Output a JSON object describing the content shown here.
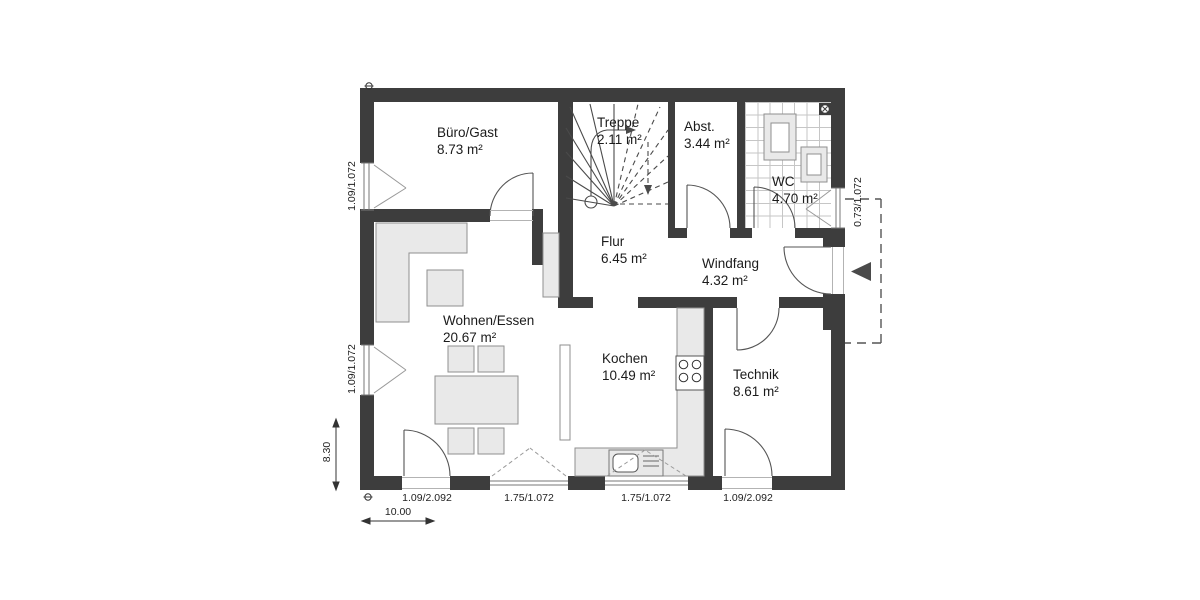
{
  "plan_title": "Erdgeschoss Grundriss",
  "rooms": {
    "buero_gast": {
      "name": "Büro/Gast",
      "area": "8.73 m²"
    },
    "treppe": {
      "name": "Treppe",
      "area": "2.11 m²"
    },
    "abstellraum": {
      "name": "Abst.",
      "area": "3.44 m²"
    },
    "wc": {
      "name": "WC",
      "area": "4.70 m²"
    },
    "flur": {
      "name": "Flur",
      "area": "6.45 m²"
    },
    "windfang": {
      "name": "Windfang",
      "area": "4.32 m²"
    },
    "wohnen_essen": {
      "name": "Wohnen/Essen",
      "area": "20.67 m²"
    },
    "kochen": {
      "name": "Kochen",
      "area": "10.49 m²"
    },
    "technik": {
      "name": "Technik",
      "area": "8.61 m²"
    }
  },
  "dimensions": {
    "window_left_upper": "1.09/1.072",
    "window_left_lower": "1.09/1.072",
    "window_right_wc": "0.73/1.072",
    "overall_depth": "8.30",
    "overall_width": "10.00",
    "door_bottom_left": "1.09/2.092",
    "window_bottom_left": "1.75/1.072",
    "window_bottom_right": "1.75/1.072",
    "door_bottom_right": "1.09/2.092"
  },
  "colors": {
    "wall": "#3d3d3d",
    "furniture_fill": "#e9e9e9",
    "furniture_stroke": "#8f8f8f",
    "tile_line": "#c6c6c6",
    "drawing_line": "#4a4a4a"
  }
}
